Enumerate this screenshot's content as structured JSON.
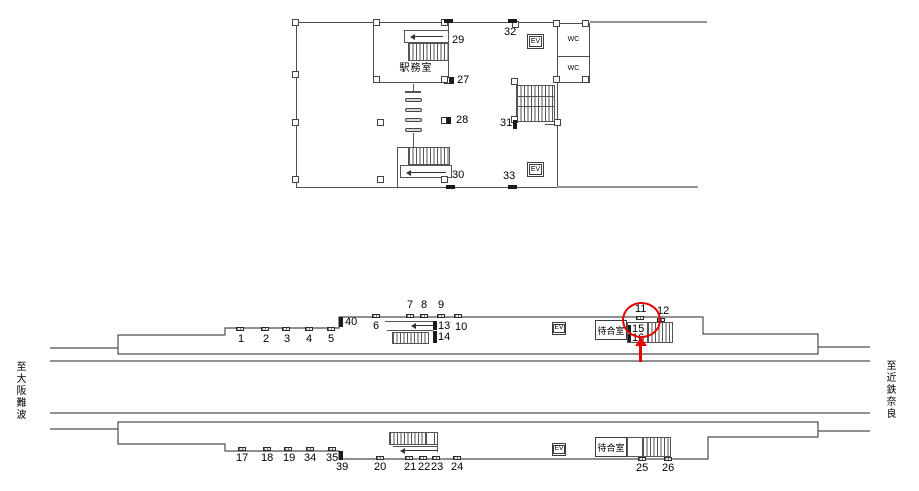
{
  "concourse": {
    "office_label": "駅務室",
    "wc_top": "WC",
    "wc_bottom": "WC",
    "ev_top": "EV",
    "ev_bottom": "EV",
    "positions": {
      "27": "27",
      "28": "28",
      "29": "29",
      "30": "30",
      "31": "31",
      "32": "32",
      "33": "33"
    }
  },
  "platforms": {
    "dest_left": "至大阪難波",
    "dest_right": "至近鉄奈良",
    "upper": {
      "ev": "EV",
      "waiting_room": "待合室",
      "positions": {
        "1": "1",
        "2": "2",
        "3": "3",
        "4": "4",
        "5": "5",
        "6": "6",
        "7": "7",
        "8": "8",
        "9": "9",
        "10": "10",
        "11": "11",
        "12": "12",
        "13": "13",
        "14": "14",
        "15": "15",
        "16": "16",
        "40": "40"
      }
    },
    "lower": {
      "ev": "EV",
      "waiting_room": "待合室",
      "positions": {
        "17": "17",
        "18": "18",
        "19": "19",
        "20": "20",
        "21": "21",
        "22": "22",
        "23": "23",
        "24": "24",
        "25": "25",
        "26": "26",
        "34": "34",
        "35": "35",
        "39": "39"
      }
    },
    "highlight": {
      "circled_position": "11",
      "color": "#e60000"
    }
  }
}
